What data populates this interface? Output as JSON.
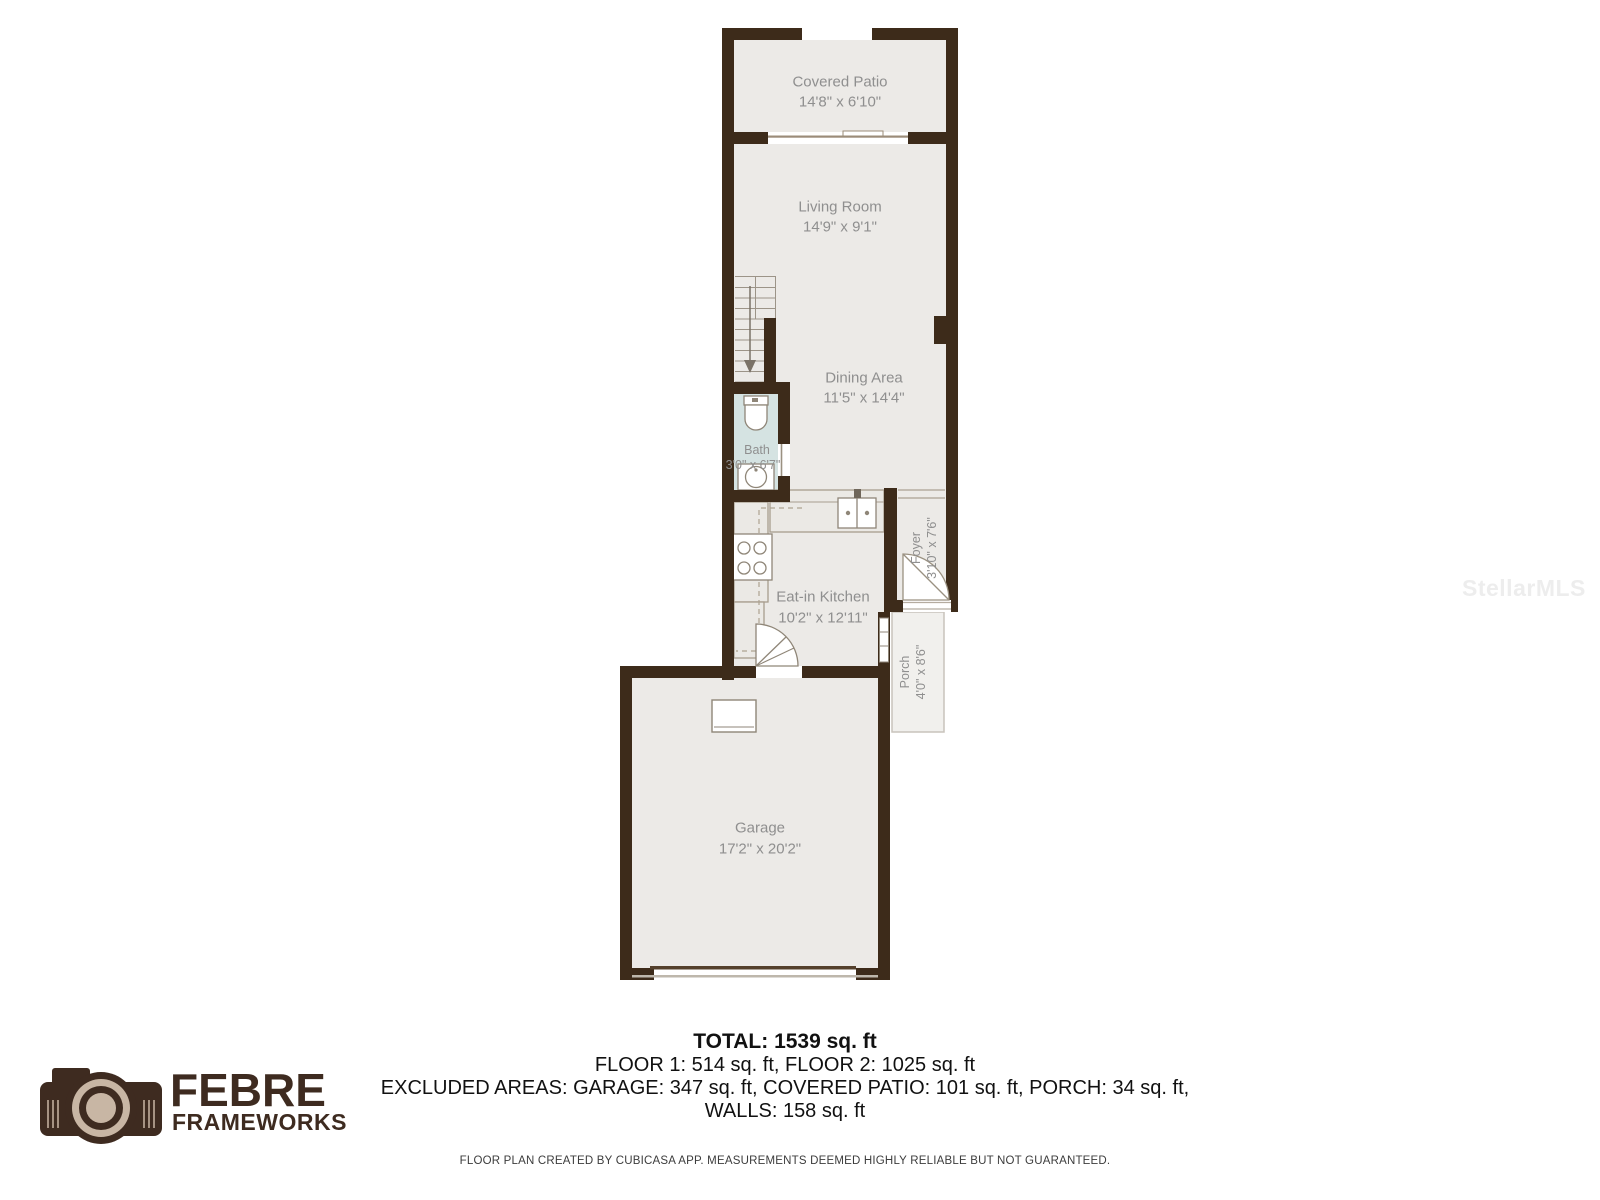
{
  "page": {
    "background": "#ffffff"
  },
  "colors": {
    "wall": "#3D2B1A",
    "floor": "#ECEAE7",
    "bath_floor": "#D5E3E2",
    "porch_floor": "#F1F0ED",
    "label_text": "#8F8F8F",
    "fixture_stroke": "#8F8678",
    "counter_fill": "#EBE9E5",
    "logo_brown": "#3E2B20",
    "logo_beige": "#C8B6A4",
    "summary_text": "#111111",
    "watermark_gray": "#ededed"
  },
  "rooms": {
    "covered_patio": {
      "name": "Covered Patio",
      "dims": "14'8\" x 6'10\""
    },
    "living_room": {
      "name": "Living Room",
      "dims": "14'9\" x 9'1\""
    },
    "dining_area": {
      "name": "Dining Area",
      "dims": "11'5\" x 14'4\""
    },
    "bath": {
      "name": "Bath",
      "dims": "3'0\" x 6'7\""
    },
    "eat_in_kitchen": {
      "name": "Eat-in Kitchen",
      "dims": "10'2\" x 12'11\""
    },
    "foyer": {
      "name": "Foyer",
      "dims": "3'10\" x 7'6\""
    },
    "porch": {
      "name": "Porch",
      "dims": "4'0\" x 8'6\""
    },
    "garage": {
      "name": "Garage",
      "dims": "17'2\" x 20'2\""
    }
  },
  "summary": {
    "total": "TOTAL: 1539 sq. ft",
    "floors": "FLOOR 1: 514 sq. ft, FLOOR 2: 1025 sq. ft",
    "excluded": "EXCLUDED AREAS: GARAGE: 347 sq. ft, COVERED PATIO: 101 sq. ft, PORCH: 34 sq. ft,",
    "walls": "WALLS: 158 sq. ft",
    "disclaimer": "FLOOR PLAN CREATED BY CUBICASA APP. MEASUREMENTS DEEMED HIGHLY RELIABLE BUT NOT GUARANTEED."
  },
  "branding": {
    "logo_line1": "FEBRE",
    "logo_line2": "FRAMEWORKS"
  },
  "watermark": {
    "text": "StellarMLS"
  }
}
